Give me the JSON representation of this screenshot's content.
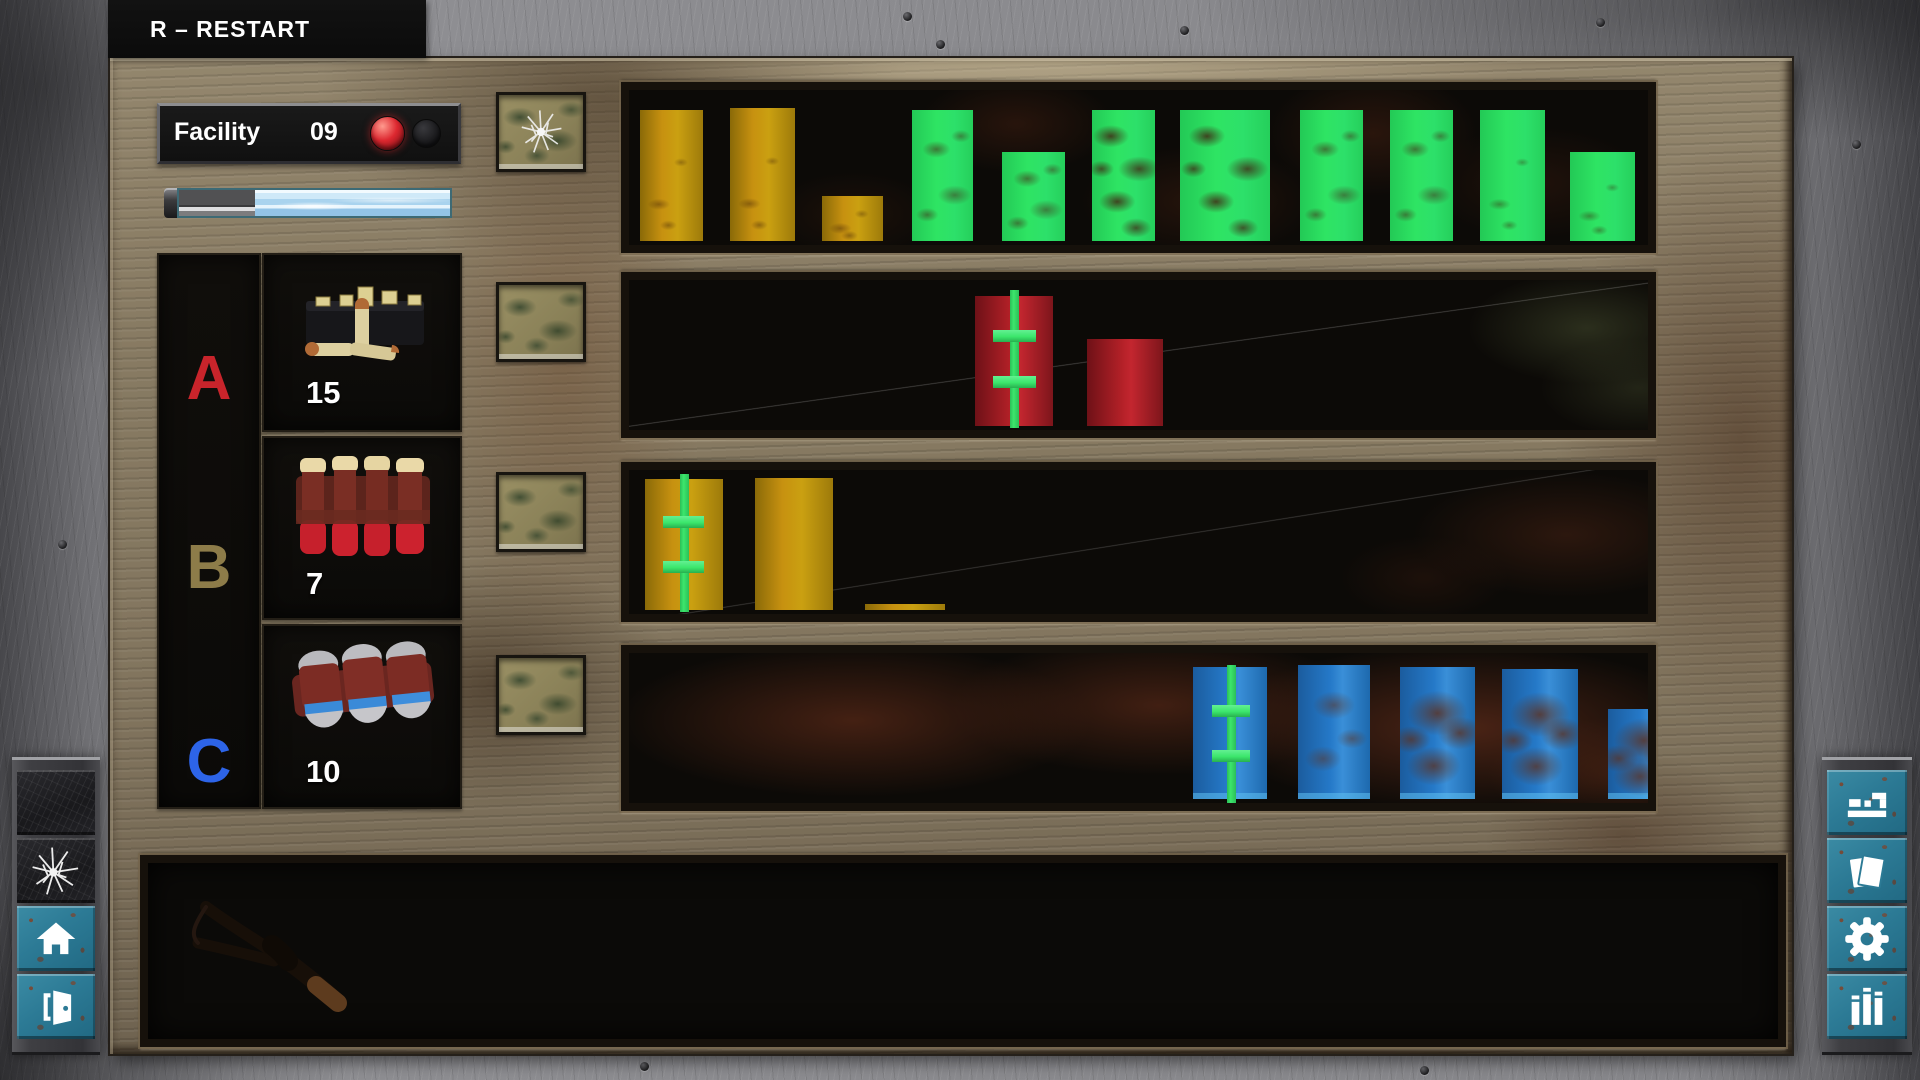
{
  "hud": {
    "restart_hint": "R – RESTART"
  },
  "facility": {
    "label": "Facility",
    "number": "09",
    "lights": [
      {
        "name": "alarm-light-red",
        "state": "on"
      },
      {
        "name": "alarm-light-secondary",
        "state": "off"
      }
    ]
  },
  "progress_bar": {
    "depleted_percent": 28,
    "remaining_percent": 72
  },
  "ammo_slots": [
    {
      "key": "A",
      "count": "15",
      "item": "rifle-cartridge-box"
    },
    {
      "key": "B",
      "count": "7",
      "item": "red-shotgun-shells"
    },
    {
      "key": "C",
      "count": "10",
      "item": "blue-tip-shells"
    }
  ],
  "palette": {
    "gold": "#c79110",
    "green": "#2ee463",
    "red": "#b22027",
    "blue": "#2579c8",
    "marker": "#3ce66c",
    "teal": "#2c7a95",
    "keyA": "#c8242b",
    "keyB": "#8d7c49",
    "keyC": "#2d64e8",
    "light_red": "#dd2830"
  },
  "lanes": [
    {
      "name": "lane-1",
      "bars": [
        {
          "type": "gold",
          "x": 11,
          "w": 63,
          "h": 131,
          "tx": 1
        },
        {
          "type": "gold",
          "x": 101,
          "w": 65,
          "h": 133,
          "tx": 1
        },
        {
          "type": "gold",
          "x": 193,
          "w": 61,
          "h": 45,
          "tx": 1
        },
        {
          "type": "green",
          "x": 283,
          "w": 61,
          "h": 131,
          "tx": 2
        },
        {
          "type": "green",
          "x": 373,
          "w": 63,
          "h": 89,
          "tx": 2
        },
        {
          "type": "green",
          "x": 463,
          "w": 63,
          "h": 131,
          "tx": 3
        },
        {
          "type": "green",
          "x": 551,
          "w": 90,
          "h": 131,
          "tx": 3
        },
        {
          "type": "green",
          "x": 671,
          "w": 63,
          "h": 131,
          "tx": 2
        },
        {
          "type": "green",
          "x": 761,
          "w": 63,
          "h": 131,
          "tx": 2
        },
        {
          "type": "green",
          "x": 851,
          "w": 65,
          "h": 131,
          "tx": 1
        },
        {
          "type": "green",
          "x": 941,
          "w": 65,
          "h": 89,
          "tx": 1
        }
      ],
      "marker": null
    },
    {
      "name": "lane-2",
      "bars": [
        {
          "type": "red",
          "x": 346,
          "w": 78,
          "h": 130
        },
        {
          "type": "red",
          "x": 458,
          "w": 76,
          "h": 87
        }
      ],
      "marker": {
        "line_x": 381,
        "line_top": 10,
        "line_h": 138,
        "cross_x": 364,
        "cross_w": 43,
        "cross_y1": 50,
        "cross_y2": 96
      }
    },
    {
      "name": "lane-3",
      "bars": [
        {
          "type": "gold",
          "x": 16,
          "w": 78,
          "h": 131
        },
        {
          "type": "gold",
          "x": 126,
          "w": 78,
          "h": 132
        },
        {
          "type": "gold",
          "x": 236,
          "w": 80,
          "h": 6
        }
      ],
      "marker": {
        "line_x": 51,
        "line_top": 4,
        "line_h": 138,
        "cross_x": 34,
        "cross_w": 41,
        "cross_y1": 46,
        "cross_y2": 91
      }
    },
    {
      "name": "lane-4",
      "bars": [
        {
          "type": "blue",
          "x": 564,
          "w": 74,
          "h": 132
        },
        {
          "type": "blue",
          "x": 669,
          "w": 72,
          "h": 134,
          "tx": 4
        },
        {
          "type": "blue",
          "x": 771,
          "w": 75,
          "h": 132,
          "tx": 5
        },
        {
          "type": "blue",
          "x": 873,
          "w": 76,
          "h": 130,
          "tx": 5
        },
        {
          "type": "blue",
          "x": 979,
          "w": 72,
          "h": 90,
          "tx": 5
        }
      ],
      "marker": {
        "line_x": 598,
        "line_top": 12,
        "line_h": 138,
        "cross_x": 583,
        "cross_w": 38,
        "cross_y1": 52,
        "cross_y2": 97
      }
    }
  ],
  "lane_buttons": [
    {
      "name": "lane-button-1",
      "cracked": true
    },
    {
      "name": "lane-button-2",
      "cracked": false
    },
    {
      "name": "lane-button-3",
      "cracked": false
    },
    {
      "name": "lane-button-4",
      "cracked": false
    }
  ],
  "toolbar_left": [
    {
      "name": "texture-marble-button",
      "icon": "marble-texture"
    },
    {
      "name": "texture-shatter-button",
      "icon": "shatter-icon"
    },
    {
      "name": "home-button",
      "icon": "home-icon"
    },
    {
      "name": "exit-button",
      "icon": "exit-door-icon"
    }
  ],
  "toolbar_right": [
    {
      "name": "levels-button",
      "icon": "levels-icon"
    },
    {
      "name": "notes-button",
      "icon": "documents-icon"
    },
    {
      "name": "settings-button",
      "icon": "gear-icon"
    },
    {
      "name": "stats-button",
      "icon": "stats-icon"
    }
  ]
}
